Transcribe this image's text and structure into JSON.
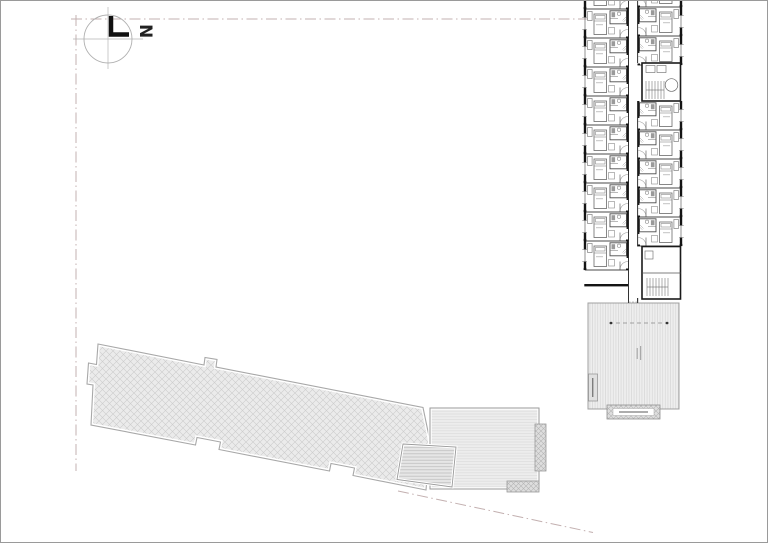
{
  "page": {
    "background": "#ffffff",
    "frame_color": "#9a9a9a"
  },
  "compass": {
    "north_label": "N"
  },
  "boundary": {
    "style": "dash-dot",
    "color": "#c3b0b0"
  },
  "main_building": {
    "left_rooms": 9,
    "right_rooms_upper": 2,
    "right_rooms_lower": 5,
    "room_pitch_px": 29,
    "stair_cores": 2
  },
  "existing_building": {
    "hatch": "diagonal-crosshatch"
  },
  "terrace": {
    "hatch": "vertical-stripes",
    "canopy_dots": 2
  },
  "deck": {
    "hatch": "horizontal-stripes"
  },
  "garden_stairs": {
    "hatch": "dense-horizontal-stripes"
  }
}
